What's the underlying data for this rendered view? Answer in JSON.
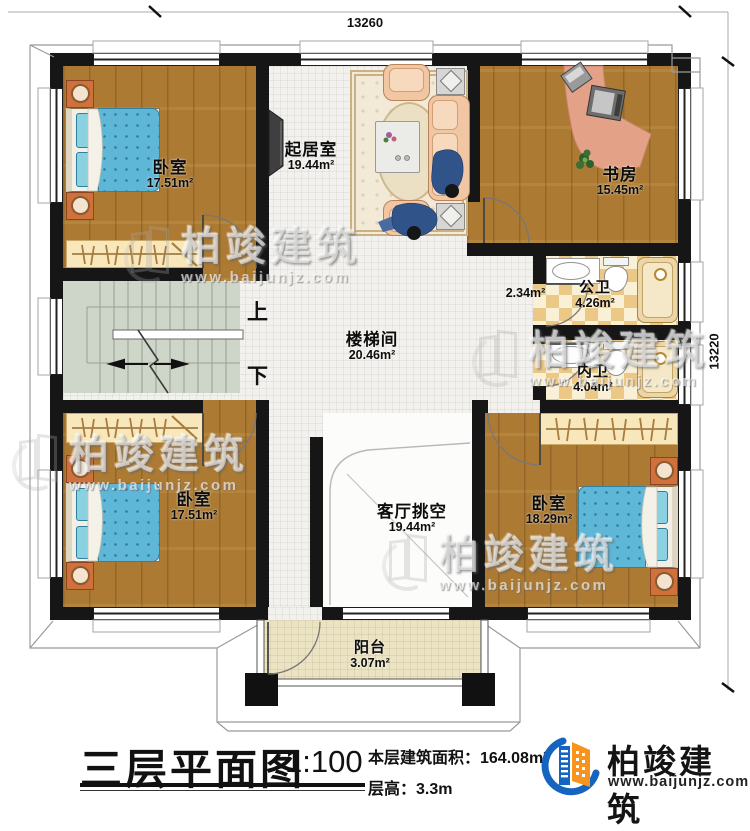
{
  "dimensions": {
    "top": "13260",
    "right": "13220"
  },
  "rooms": {
    "bedroom_tl": {
      "name": "卧室",
      "area": "17.51m²"
    },
    "living": {
      "name": "起居室",
      "area": "19.44m²"
    },
    "study": {
      "name": "书房",
      "area": "15.45m²"
    },
    "public_bath": {
      "name": "公卫",
      "area": "4.26m²"
    },
    "corridor": {
      "area": "2.34m²"
    },
    "private_bath": {
      "name": "内卫",
      "area": "4.04m²"
    },
    "stairwell": {
      "name": "楼梯间",
      "area": "20.46m²"
    },
    "void": {
      "name": "客厅挑空",
      "area": "19.44m²"
    },
    "bedroom_bl": {
      "name": "卧室",
      "area": "17.51m²"
    },
    "bedroom_br": {
      "name": "卧室",
      "area": "18.29m²"
    },
    "balcony": {
      "name": "阳台",
      "area": "3.07m²"
    }
  },
  "stairs": {
    "up": "上",
    "down": "下"
  },
  "titleblock": {
    "title": "三层平面图",
    "scale": "1:100",
    "area_line": "本层建筑面积：164.08m²",
    "height_line": "层高：3.3m"
  },
  "brand": {
    "name": "柏竣建筑",
    "url": "www.baijunjz.com"
  },
  "watermark": {
    "name": "柏竣建筑",
    "url": "www.baijunjz.com"
  },
  "colors": {
    "wall": "#161616",
    "wood": "#ac7a33",
    "tile": "#f2f1ed",
    "checker": "#ebc885",
    "stairs": "#ced5c9",
    "balcony": "#ebe3c2",
    "brand_blue": "#1565c0",
    "brand_orange": "#f7941d"
  }
}
